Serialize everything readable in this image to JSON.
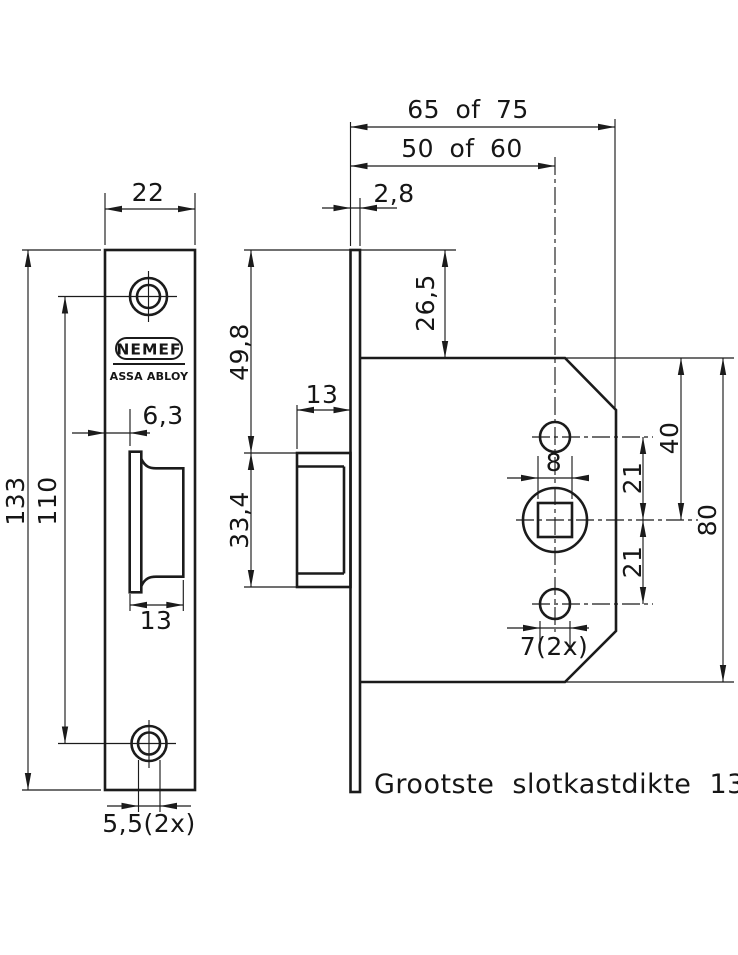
{
  "brand": {
    "name": "NEMEF",
    "sub": "ASSA ABLOY"
  },
  "note": "Grootste slotkastdikte 13 mm",
  "dims": {
    "plate_width": "22",
    "plate_height": "133",
    "screw_spacing": "110",
    "latch_offset": "6,3",
    "latch_width_front": "13",
    "screw_hole_dia": "5,5(2x)",
    "latch_depth_side": "13",
    "top_to_latch": "49,8",
    "latch_height": "33,4",
    "plate_thickness": "2,8",
    "case_depth": "65 of 75",
    "backset": "50 of 60",
    "top_offset": "26,5",
    "spindle_square": "8",
    "spindle_to_top_hole": "21",
    "spindle_to_bottom_hole": "21",
    "top_to_spindle": "40",
    "case_height": "80",
    "fixing_hole_dia": "7(2x)"
  }
}
